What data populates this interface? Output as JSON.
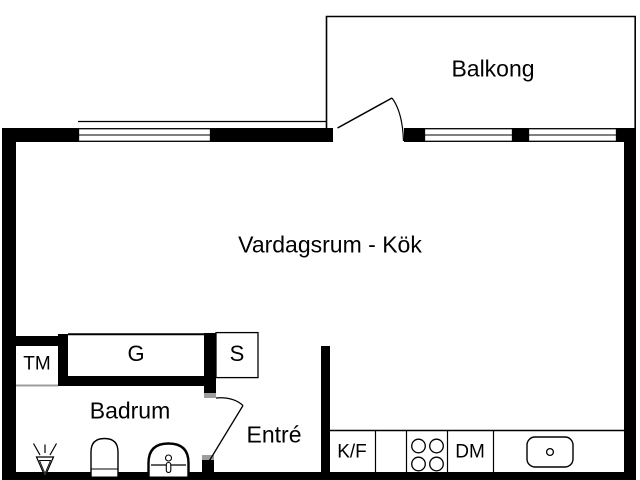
{
  "rooms": {
    "balcony": {
      "label": "Balkong"
    },
    "living": {
      "label": "Vardagsrum - Kök"
    },
    "bathroom": {
      "label": "Badrum"
    },
    "hall": {
      "label": "Entré"
    }
  },
  "fixtures": {
    "washing_machine": {
      "label": "TM"
    },
    "wardrobe": {
      "label": "G"
    },
    "closet": {
      "label": "S"
    },
    "fridge_freezer": {
      "label": "K/F"
    },
    "dishwasher": {
      "label": "DM"
    }
  },
  "colors": {
    "wall": "#000000",
    "background": "#ffffff",
    "hinge_gray": "#9d9d9d"
  }
}
